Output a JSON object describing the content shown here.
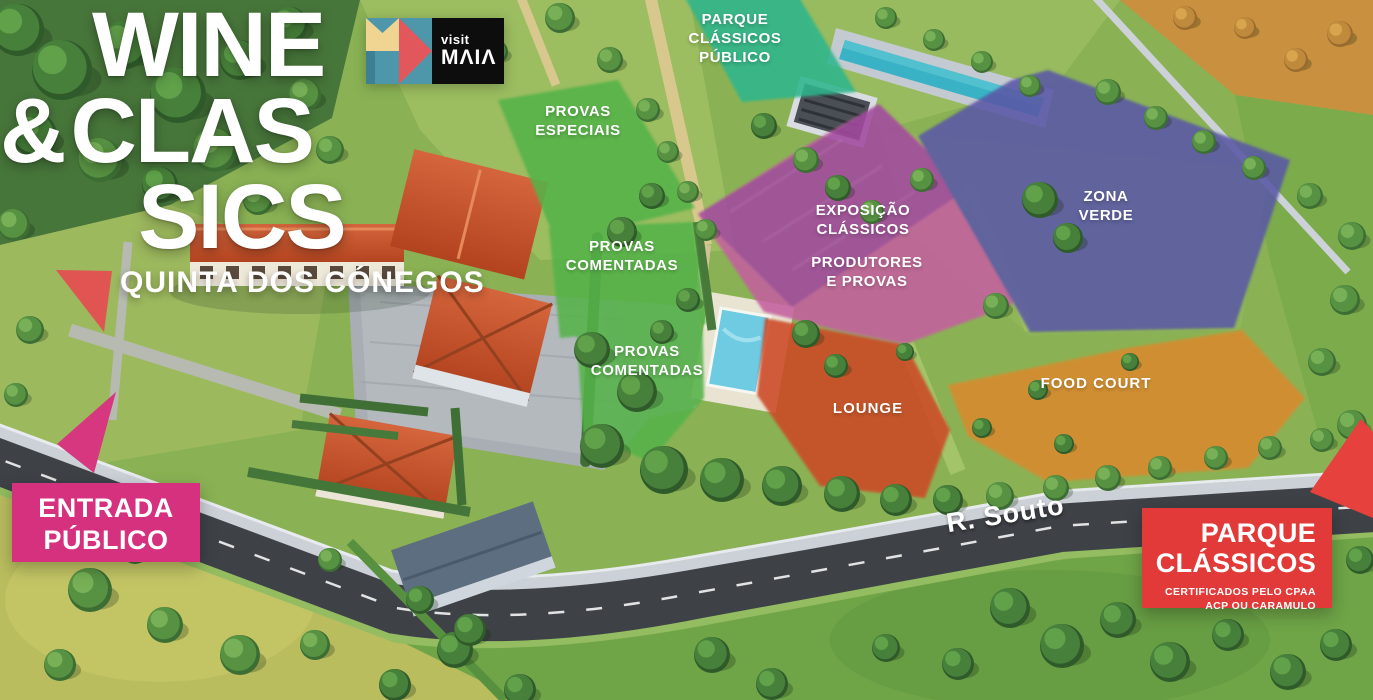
{
  "event": {
    "title_line1": "WINE",
    "title_amp": "&",
    "title_line2": "CLAS",
    "title_line3": "SICS",
    "venue": "QUINTA DOS CÓNEGOS"
  },
  "logo": {
    "visit": "visit",
    "brand": "MΛIΛ"
  },
  "zones": [
    {
      "id": "parque-classicos-publico",
      "lines": [
        "PARQUE",
        "CLÁSSICOS",
        "PÚBLICO"
      ],
      "color": "#2eb68d"
    },
    {
      "id": "provas-especiais",
      "lines": [
        "PROVAS",
        "ESPECIAIS"
      ],
      "color": "#55b34a"
    },
    {
      "id": "provas-comentadas-1",
      "lines": [
        "PROVAS",
        "COMENTADAS"
      ],
      "color": "#55b34a"
    },
    {
      "id": "provas-comentadas-2",
      "lines": [
        "PROVAS",
        "COMENTADAS"
      ],
      "color": "#55b34a"
    },
    {
      "id": "exposicao-classicos",
      "lines": [
        "EXPOSIÇÃO",
        "CLÁSSICOS"
      ],
      "color": "#a348a0"
    },
    {
      "id": "produtores-e-provas",
      "lines": [
        "PRODUTORES",
        "E PROVAS"
      ],
      "color": "#c4609f"
    },
    {
      "id": "zona-verde",
      "lines": [
        "ZONA",
        "VERDE"
      ],
      "color": "#5a58a6"
    },
    {
      "id": "lounge",
      "lines": [
        "LOUNGE"
      ],
      "color": "#cd4a27"
    },
    {
      "id": "food-court",
      "lines": [
        "FOOD COURT"
      ],
      "color": "#d98a2f"
    }
  ],
  "road": {
    "name": "R. Souto"
  },
  "callouts": {
    "entrada": {
      "line1": "ENTRADA",
      "line2": "PÚBLICO",
      "color": "#d5317e"
    },
    "parque_classicos": {
      "line1": "PARQUE",
      "line2": "CLÁSSICOS",
      "note1": "CERTIFICADOS PELO CPAA",
      "note2": "ACP OU CARAMULO",
      "color": "#e23a38"
    }
  },
  "arrows": {
    "quinta": {
      "color": "#e05551"
    },
    "entrada": {
      "color": "#d6377f"
    },
    "parque": {
      "color": "#e6413d"
    }
  }
}
